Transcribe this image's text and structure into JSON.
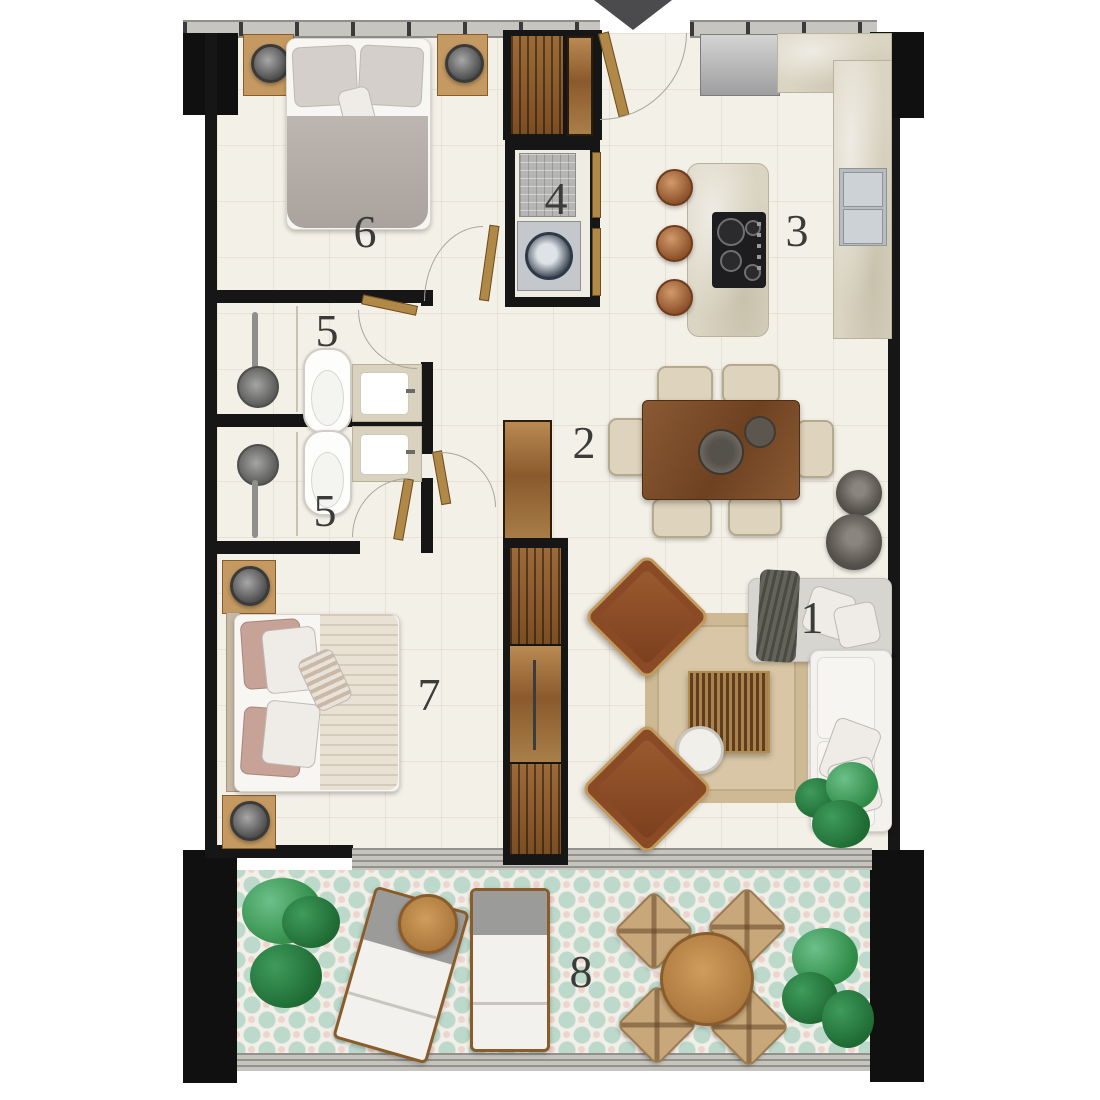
{
  "labels": {
    "living_room": "1",
    "hallway": "2",
    "kitchen": "3",
    "laundry": "4",
    "bathroom_upper": "5",
    "bathroom_lower": "5",
    "bedroom_upper": "6",
    "bedroom_lower": "7",
    "terrace": "8"
  },
  "entrance": {
    "icon": "down-arrow"
  },
  "colors": {
    "wall": "#161616",
    "floor": "#f3f0e7",
    "terrace_tile_accent": "#bcd9cc",
    "marble": "#dad4c2",
    "wood_dark": "#7c4e24",
    "wood_light": "#c59a62",
    "sofa_white": "#f3f2ef",
    "plant_green": "#3f9b4f"
  }
}
